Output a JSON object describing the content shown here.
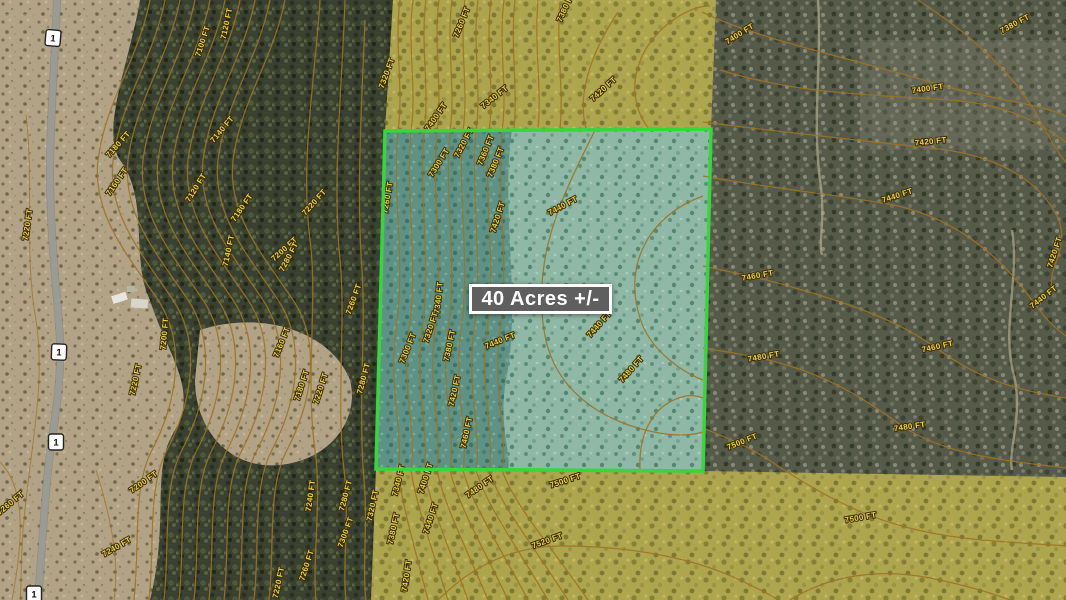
{
  "map": {
    "acreage_label": "40 Acres +/-",
    "highway_shield_label": "1",
    "contour_unit": "FT",
    "colors": {
      "parcel_border": "#35d73a",
      "parcel_fill_west": "#5e9286",
      "parcel_fill_east": "#8fb8a6",
      "public_land_overlay": "#b2a84f",
      "contour_line": "#9d7322",
      "contour_label": "#ead43c",
      "acreage_box_bg": "#5f5f5f",
      "acreage_box_border": "#ffffff"
    },
    "shields": [
      {
        "x": 53,
        "y": 38,
        "r": 5
      },
      {
        "x": 59,
        "y": 352,
        "r": 2
      },
      {
        "x": 56,
        "y": 442,
        "r": 0
      },
      {
        "x": 34,
        "y": 594,
        "r": 0
      }
    ],
    "contour_labels": [
      {
        "text": "7220 FT",
        "x": 30,
        "y": 225,
        "r": -82
      },
      {
        "text": "7260 FT",
        "x": 12,
        "y": 505,
        "r": -40
      },
      {
        "text": "7240 FT",
        "x": 118,
        "y": 549,
        "r": -30
      },
      {
        "text": "7200 FT",
        "x": 145,
        "y": 484,
        "r": -35
      },
      {
        "text": "7200 FT",
        "x": 167,
        "y": 334,
        "r": -85
      },
      {
        "text": "7220 FT",
        "x": 138,
        "y": 380,
        "r": -78
      },
      {
        "text": "7100 FT",
        "x": 205,
        "y": 42,
        "r": -72
      },
      {
        "text": "7120 FT",
        "x": 229,
        "y": 24,
        "r": -78
      },
      {
        "text": "7140 FT",
        "x": 224,
        "y": 131,
        "r": -50
      },
      {
        "text": "7180 FT",
        "x": 120,
        "y": 146,
        "r": -48
      },
      {
        "text": "7160 FT",
        "x": 119,
        "y": 183,
        "r": -55
      },
      {
        "text": "7120 FT",
        "x": 198,
        "y": 189,
        "r": -58
      },
      {
        "text": "7180 FT",
        "x": 244,
        "y": 209,
        "r": -55
      },
      {
        "text": "7140 FT",
        "x": 231,
        "y": 251,
        "r": -78
      },
      {
        "text": "7200 FT",
        "x": 286,
        "y": 251,
        "r": -42
      },
      {
        "text": "7220 FT",
        "x": 316,
        "y": 204,
        "r": -48
      },
      {
        "text": "7280 FT",
        "x": 291,
        "y": 258,
        "r": -62
      },
      {
        "text": "7160 FT",
        "x": 284,
        "y": 343,
        "r": -68
      },
      {
        "text": "7180 FT",
        "x": 304,
        "y": 386,
        "r": -72
      },
      {
        "text": "7220 FT",
        "x": 323,
        "y": 389,
        "r": -72
      },
      {
        "text": "7280 FT",
        "x": 366,
        "y": 379,
        "r": -75
      },
      {
        "text": "7260 FT",
        "x": 356,
        "y": 300,
        "r": -70
      },
      {
        "text": "7240 FT",
        "x": 313,
        "y": 496,
        "r": -82
      },
      {
        "text": "7280 FT",
        "x": 348,
        "y": 496,
        "r": -75
      },
      {
        "text": "7300 FT",
        "x": 348,
        "y": 533,
        "r": -70
      },
      {
        "text": "7320 FT",
        "x": 375,
        "y": 506,
        "r": -78
      },
      {
        "text": "7220 FT",
        "x": 281,
        "y": 583,
        "r": -78
      },
      {
        "text": "7260 FT",
        "x": 309,
        "y": 566,
        "r": -72
      },
      {
        "text": "7320 FT",
        "x": 389,
        "y": 74,
        "r": -70
      },
      {
        "text": "7260 FT",
        "x": 464,
        "y": 23,
        "r": -68
      },
      {
        "text": "7340 FT",
        "x": 496,
        "y": 99,
        "r": -38
      },
      {
        "text": "7380 FT",
        "x": 568,
        "y": 8,
        "r": -65
      },
      {
        "text": "7420 FT",
        "x": 605,
        "y": 91,
        "r": -42
      },
      {
        "text": "7400 FT",
        "x": 438,
        "y": 118,
        "r": -55
      },
      {
        "text": "7260 FT",
        "x": 390,
        "y": 198,
        "r": -80
      },
      {
        "text": "7300 FT",
        "x": 441,
        "y": 164,
        "r": -58
      },
      {
        "text": "7320 FT",
        "x": 466,
        "y": 144,
        "r": -62
      },
      {
        "text": "7360 FT",
        "x": 488,
        "y": 151,
        "r": -68
      },
      {
        "text": "7380 FT",
        "x": 498,
        "y": 163,
        "r": -68
      },
      {
        "text": "7420 FT",
        "x": 500,
        "y": 218,
        "r": -72
      },
      {
        "text": "7440 FT",
        "x": 564,
        "y": 208,
        "r": -28
      },
      {
        "text": "7340 FT",
        "x": 441,
        "y": 298,
        "r": -84
      },
      {
        "text": "7320 FT",
        "x": 433,
        "y": 328,
        "r": -72
      },
      {
        "text": "7300 FT",
        "x": 410,
        "y": 349,
        "r": -68
      },
      {
        "text": "7380 FT",
        "x": 452,
        "y": 346,
        "r": -78
      },
      {
        "text": "7420 FT",
        "x": 457,
        "y": 391,
        "r": -78
      },
      {
        "text": "7440 FT",
        "x": 501,
        "y": 343,
        "r": -22
      },
      {
        "text": "7460 FT",
        "x": 469,
        "y": 433,
        "r": -78
      },
      {
        "text": "7440 FT",
        "x": 601,
        "y": 326,
        "r": -48
      },
      {
        "text": "7480 FT",
        "x": 633,
        "y": 371,
        "r": -48
      },
      {
        "text": "7400 FT",
        "x": 741,
        "y": 36,
        "r": -32
      },
      {
        "text": "7400 FT",
        "x": 928,
        "y": 91,
        "r": -8
      },
      {
        "text": "7380 FT",
        "x": 1016,
        "y": 26,
        "r": -28
      },
      {
        "text": "7420 FT",
        "x": 931,
        "y": 144,
        "r": -6
      },
      {
        "text": "7440 FT",
        "x": 898,
        "y": 198,
        "r": -18
      },
      {
        "text": "7460 FT",
        "x": 758,
        "y": 278,
        "r": -10
      },
      {
        "text": "7420 FT",
        "x": 1057,
        "y": 253,
        "r": -72
      },
      {
        "text": "7440 FT",
        "x": 1045,
        "y": 299,
        "r": -38
      },
      {
        "text": "7480 FT",
        "x": 764,
        "y": 359,
        "r": -10
      },
      {
        "text": "7460 FT",
        "x": 938,
        "y": 349,
        "r": -12
      },
      {
        "text": "7480 FT",
        "x": 910,
        "y": 429,
        "r": -8
      },
      {
        "text": "7500 FT",
        "x": 743,
        "y": 444,
        "r": -22
      },
      {
        "text": "7500 FT",
        "x": 861,
        "y": 520,
        "r": -10
      },
      {
        "text": "7340 FT",
        "x": 401,
        "y": 481,
        "r": -75
      },
      {
        "text": "7400 FT",
        "x": 428,
        "y": 479,
        "r": -72
      },
      {
        "text": "7480 FT",
        "x": 481,
        "y": 489,
        "r": -35
      },
      {
        "text": "7500 FT",
        "x": 566,
        "y": 483,
        "r": -18
      },
      {
        "text": "7380 FT",
        "x": 396,
        "y": 529,
        "r": -78
      },
      {
        "text": "7440 FT",
        "x": 433,
        "y": 519,
        "r": -72
      },
      {
        "text": "7520 FT",
        "x": 548,
        "y": 543,
        "r": -20
      },
      {
        "text": "7420 FT",
        "x": 409,
        "y": 576,
        "r": -82
      }
    ]
  }
}
